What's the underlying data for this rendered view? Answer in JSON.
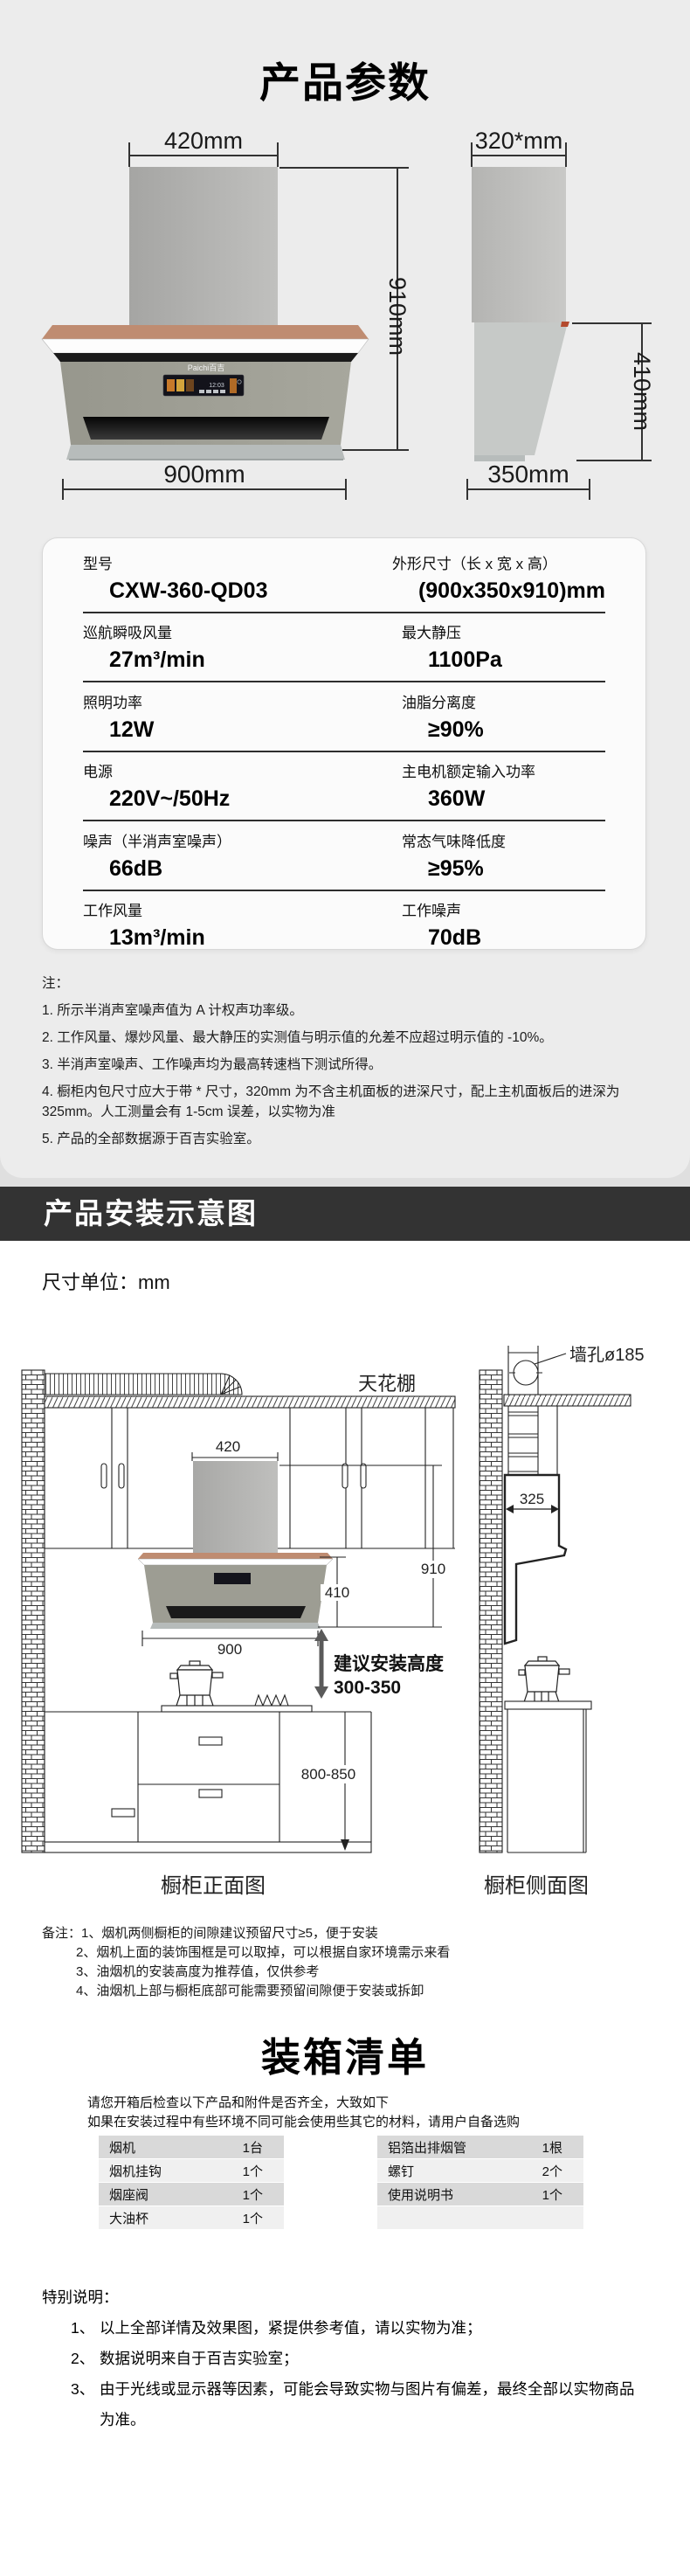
{
  "header": {
    "title": "产品参数"
  },
  "figure": {
    "front": {
      "top_width": "420mm",
      "height": "910mm",
      "bottom_width": "900mm",
      "brand": "Paichi百吉",
      "display_time": "12:03"
    },
    "side": {
      "top_width": "320*mm",
      "height": "410mm",
      "bottom_depth": "350mm"
    }
  },
  "specs": {
    "rows": [
      {
        "l_label": "型号",
        "l_value": "CXW-360-QD03",
        "r_label": "外形尺寸（长 x 宽 x 高）",
        "r_value": "(900x350x910)mm"
      },
      {
        "l_label": "巡航瞬吸风量",
        "l_value": "27m³/min",
        "r_label": "最大静压",
        "r_value": "1100Pa"
      },
      {
        "l_label": "照明功率",
        "l_value": "12W",
        "r_label": "油脂分离度",
        "r_value": "≥90%"
      },
      {
        "l_label": "电源",
        "l_value": "220V~/50Hz",
        "r_label": "主电机额定输入功率",
        "r_value": "360W"
      },
      {
        "l_label": "噪声（半消声室噪声）",
        "l_value": "66dB",
        "r_label": "常态气味降低度",
        "r_value": "≥95%"
      },
      {
        "l_label": "工作风量",
        "l_value": "13m³/min",
        "r_label": "工作噪声",
        "r_value": "70dB"
      }
    ]
  },
  "notes": {
    "heading": "注：",
    "items": [
      "1. 所示半消声室噪声值为 A 计权声功率级。",
      "2. 工作风量、爆炒风量、最大静压的实测值与明示值的允差不应超过明示值的 -10%。",
      "3. 半消声室噪声、工作噪声均为最高转速档下测试所得。",
      "4. 橱柜内包尺寸应大于带 * 尺寸，320mm 为不含主机面板的进深尺寸，配上主机面板后的进深为 325mm。人工测量会有 1-5cm 误差，以实物为准",
      "5. 产品的全部数据源于百吉实验室。"
    ]
  },
  "install": {
    "banner": "产品安装示意图",
    "unit": "尺寸单位：mm",
    "labels": {
      "ceiling": "天花棚",
      "wall_hole": "墙孔ø185",
      "chimney_width": "420",
      "total_height": "910",
      "hood_height": "410",
      "hood_width": "900",
      "suggest_line1": "建议安装高度",
      "suggest_line2": "300-350",
      "counter_height": "800-850",
      "depth": "325",
      "front_caption": "橱柜正面图",
      "side_caption": "橱柜侧面图"
    },
    "remarks": {
      "line1": "备注：1、烟机两侧橱柜的间隙建议预留尺寸≥5，便于安装",
      "items": [
        "2、烟机上面的装饰围框是可以取掉，可以根据自家环境需示来看",
        "3、油烟机的安装高度为推荐值，仅供参考",
        "4、油烟机上部与橱柜底部可能需要预留间隙便于安装或拆卸"
      ]
    }
  },
  "packing": {
    "title": "装箱清单",
    "intro": [
      "请您开箱后检查以下产品和附件是否齐全，大致如下",
      "如果在安装过程中有些环境不同可能会使用些其它的材料，请用户自备选购"
    ],
    "left_table": [
      {
        "name": "烟机",
        "qty": "1台"
      },
      {
        "name": "烟机挂钩",
        "qty": "1个"
      },
      {
        "name": "烟座阀",
        "qty": "1个"
      },
      {
        "name": "大油杯",
        "qty": "1个"
      }
    ],
    "right_table": [
      {
        "name": "铝箔出排烟管",
        "qty": "1根"
      },
      {
        "name": "螺钉",
        "qty": "2个"
      },
      {
        "name": "使用说明书",
        "qty": "1个"
      },
      {
        "name": "",
        "qty": ""
      }
    ]
  },
  "special": {
    "heading": "特别说明：",
    "items": [
      {
        "num": "1、",
        "text": "以上全部详情及效果图，紧提供参考值，请以实物为准；"
      },
      {
        "num": "2、",
        "text": "数据说明来自于百吉实验室；"
      },
      {
        "num": "3、",
        "text": "由于光线或显示器等因素，可能会导致实物与图片有偏差，最终全部以实物商品为准。"
      }
    ]
  },
  "colors": {
    "section_bg": "#ececec",
    "banner_bg": "#333333",
    "copper_accent": "#bf8c71",
    "hood_body": "#9d9d93",
    "table_row_dark": "#d9d9d9",
    "table_row_light": "#f0f0f0"
  }
}
